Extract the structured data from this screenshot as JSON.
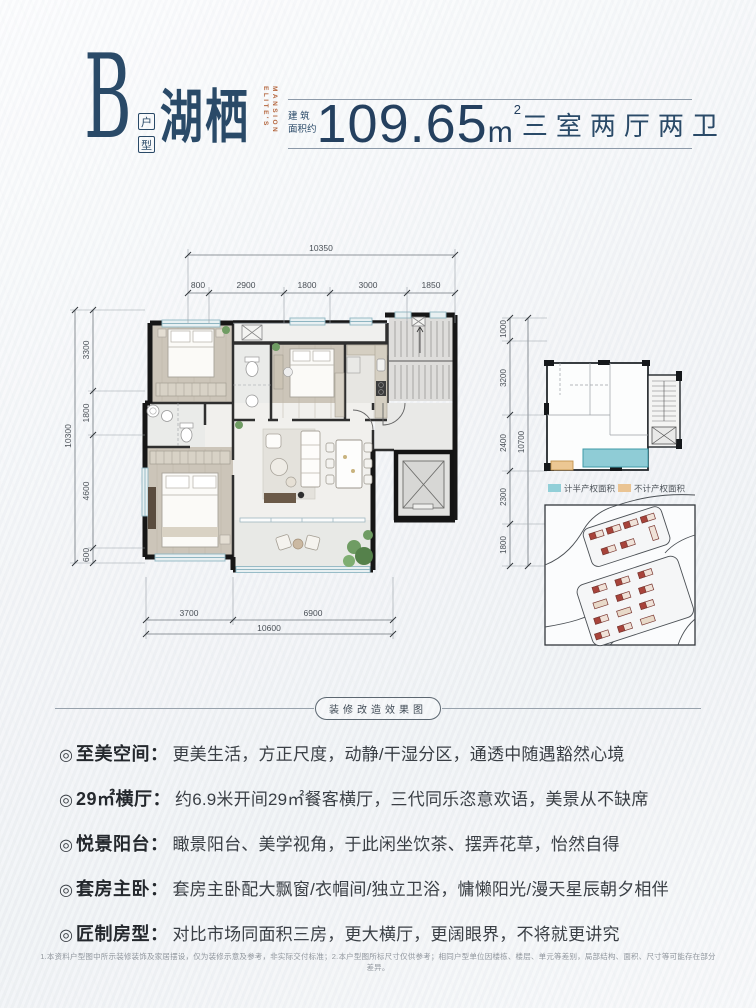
{
  "header": {
    "type_letter": "B",
    "type_label_chars": [
      "户",
      "型"
    ],
    "name": "湖栖",
    "name_en_lines": [
      "ELITE'S",
      "MANSION"
    ],
    "area_label_line1": "建 筑",
    "area_label_line2": "面积约",
    "area_value": "109.65",
    "area_unit": "m",
    "area_sup": "2",
    "layout_text": "三室两厅两卫"
  },
  "colors": {
    "navy": "#2a4a68",
    "orange": "#b5673f",
    "legend_teal": "#92cfd8",
    "legend_tan": "#eac493",
    "wall_black": "#161616"
  },
  "plan": {
    "dims_top": {
      "total": "10350",
      "segments": [
        "800",
        "2900",
        "1800",
        "3000",
        "1850"
      ]
    },
    "dims_left": {
      "total": "10300",
      "segments": [
        "3300",
        "1800",
        "4600",
        "600"
      ]
    },
    "dims_bottom": {
      "total": "10600",
      "segments": [
        "3700",
        "6900"
      ]
    },
    "dims_key": {
      "total": "10700",
      "segments": [
        "1000",
        "3200",
        "2400",
        "2300",
        "1800"
      ]
    }
  },
  "legend": {
    "half_property": {
      "label": "计半产权面积",
      "color": "#92cfd8"
    },
    "no_property": {
      "label": "不计产权面积",
      "color": "#eac493"
    }
  },
  "divider_badge": "装修改造效果图",
  "features": {
    "bullet_symbol": "◎",
    "colon": "：",
    "items": [
      {
        "label": "至美空间",
        "text": "更美生活，方正尺度，动静/干湿分区，通透中随遇豁然心境"
      },
      {
        "label": "29㎡横厅",
        "text": "约6.9米开间29㎡餐客横厅，三代同乐恣意欢语，美景从不缺席"
      },
      {
        "label": "悦景阳台",
        "text": "瞰景阳台、美学视角，于此闲坐饮茶、摆弄花草，怡然自得"
      },
      {
        "label": "套房主卧",
        "text": "套房主卧配大飘窗/衣帽间/独立卫浴，慵懒阳光/漫天星辰朝夕相伴"
      },
      {
        "label": "匠制房型",
        "text": "对比市场同面积三房，更大横厅，更阔眼界，不将就更讲究"
      }
    ]
  },
  "footer": {
    "disclaimer": "1.本资料户型图中所示装修装饰及家居摆设，仅为装修示意及参考，非实际交付标准；2.本户型图所标尺寸仅供参考；相同户型单位因楼栋、楼层、单元等差别，局部结构、面积、尺寸等可能存在部分差异。"
  }
}
